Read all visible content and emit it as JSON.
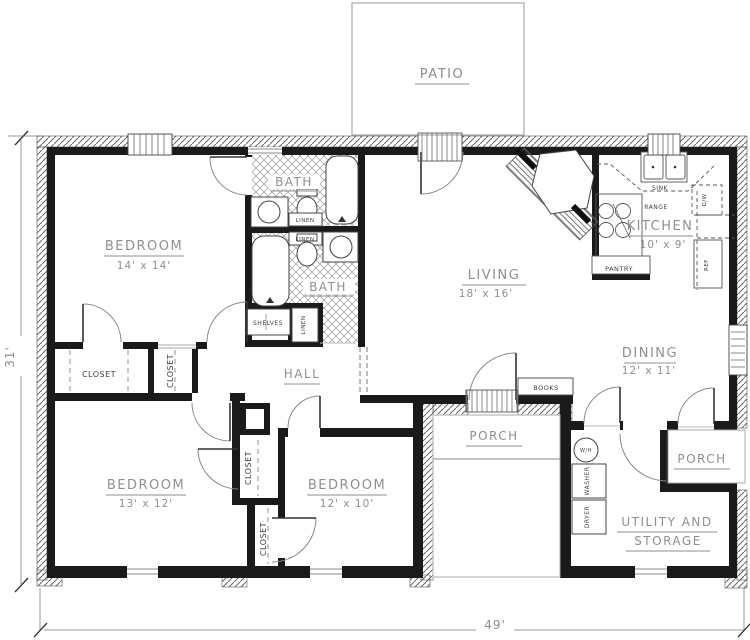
{
  "plan": {
    "patio": "PATIO",
    "living": "LIVING",
    "living_size": "18' x 16'",
    "dining": "DINING",
    "dining_size": "12' x 11'",
    "kitchen": "KITCHEN",
    "kitchen_size": "10' x 9'",
    "bedroom_master": "BEDROOM",
    "bedroom_master_size": "14' x 14'",
    "bedroom_left": "BEDROOM",
    "bedroom_left_size": "13' x 12'",
    "bedroom_mid": "BEDROOM",
    "bedroom_mid_size": "12' x 10'",
    "bath_upper": "BATH",
    "bath_lower": "BATH",
    "hall": "HALL",
    "porch_front": "PORCH",
    "porch_rear": "PORCH",
    "utility_line1": "UTILITY AND",
    "utility_line2": "STORAGE",
    "closet": "CLOSET",
    "linen": "LINEN",
    "shelves": "SHELVES",
    "books": "BOOKS",
    "sink": "SINK",
    "range": "RANGE",
    "pantry": "PANTRY",
    "ref": "REF",
    "dishwasher": "D/W",
    "water_heater": "W/H",
    "washer": "WASHER",
    "dryer": "DRYER",
    "dim_height": "31'",
    "dim_width": "49'"
  },
  "colors": {
    "wall": "#1a1a1a",
    "hatch_line": "#666666",
    "room_label": "#8f8f8f",
    "small_label": "#3f3f3f",
    "thin_line": "#777777"
  }
}
